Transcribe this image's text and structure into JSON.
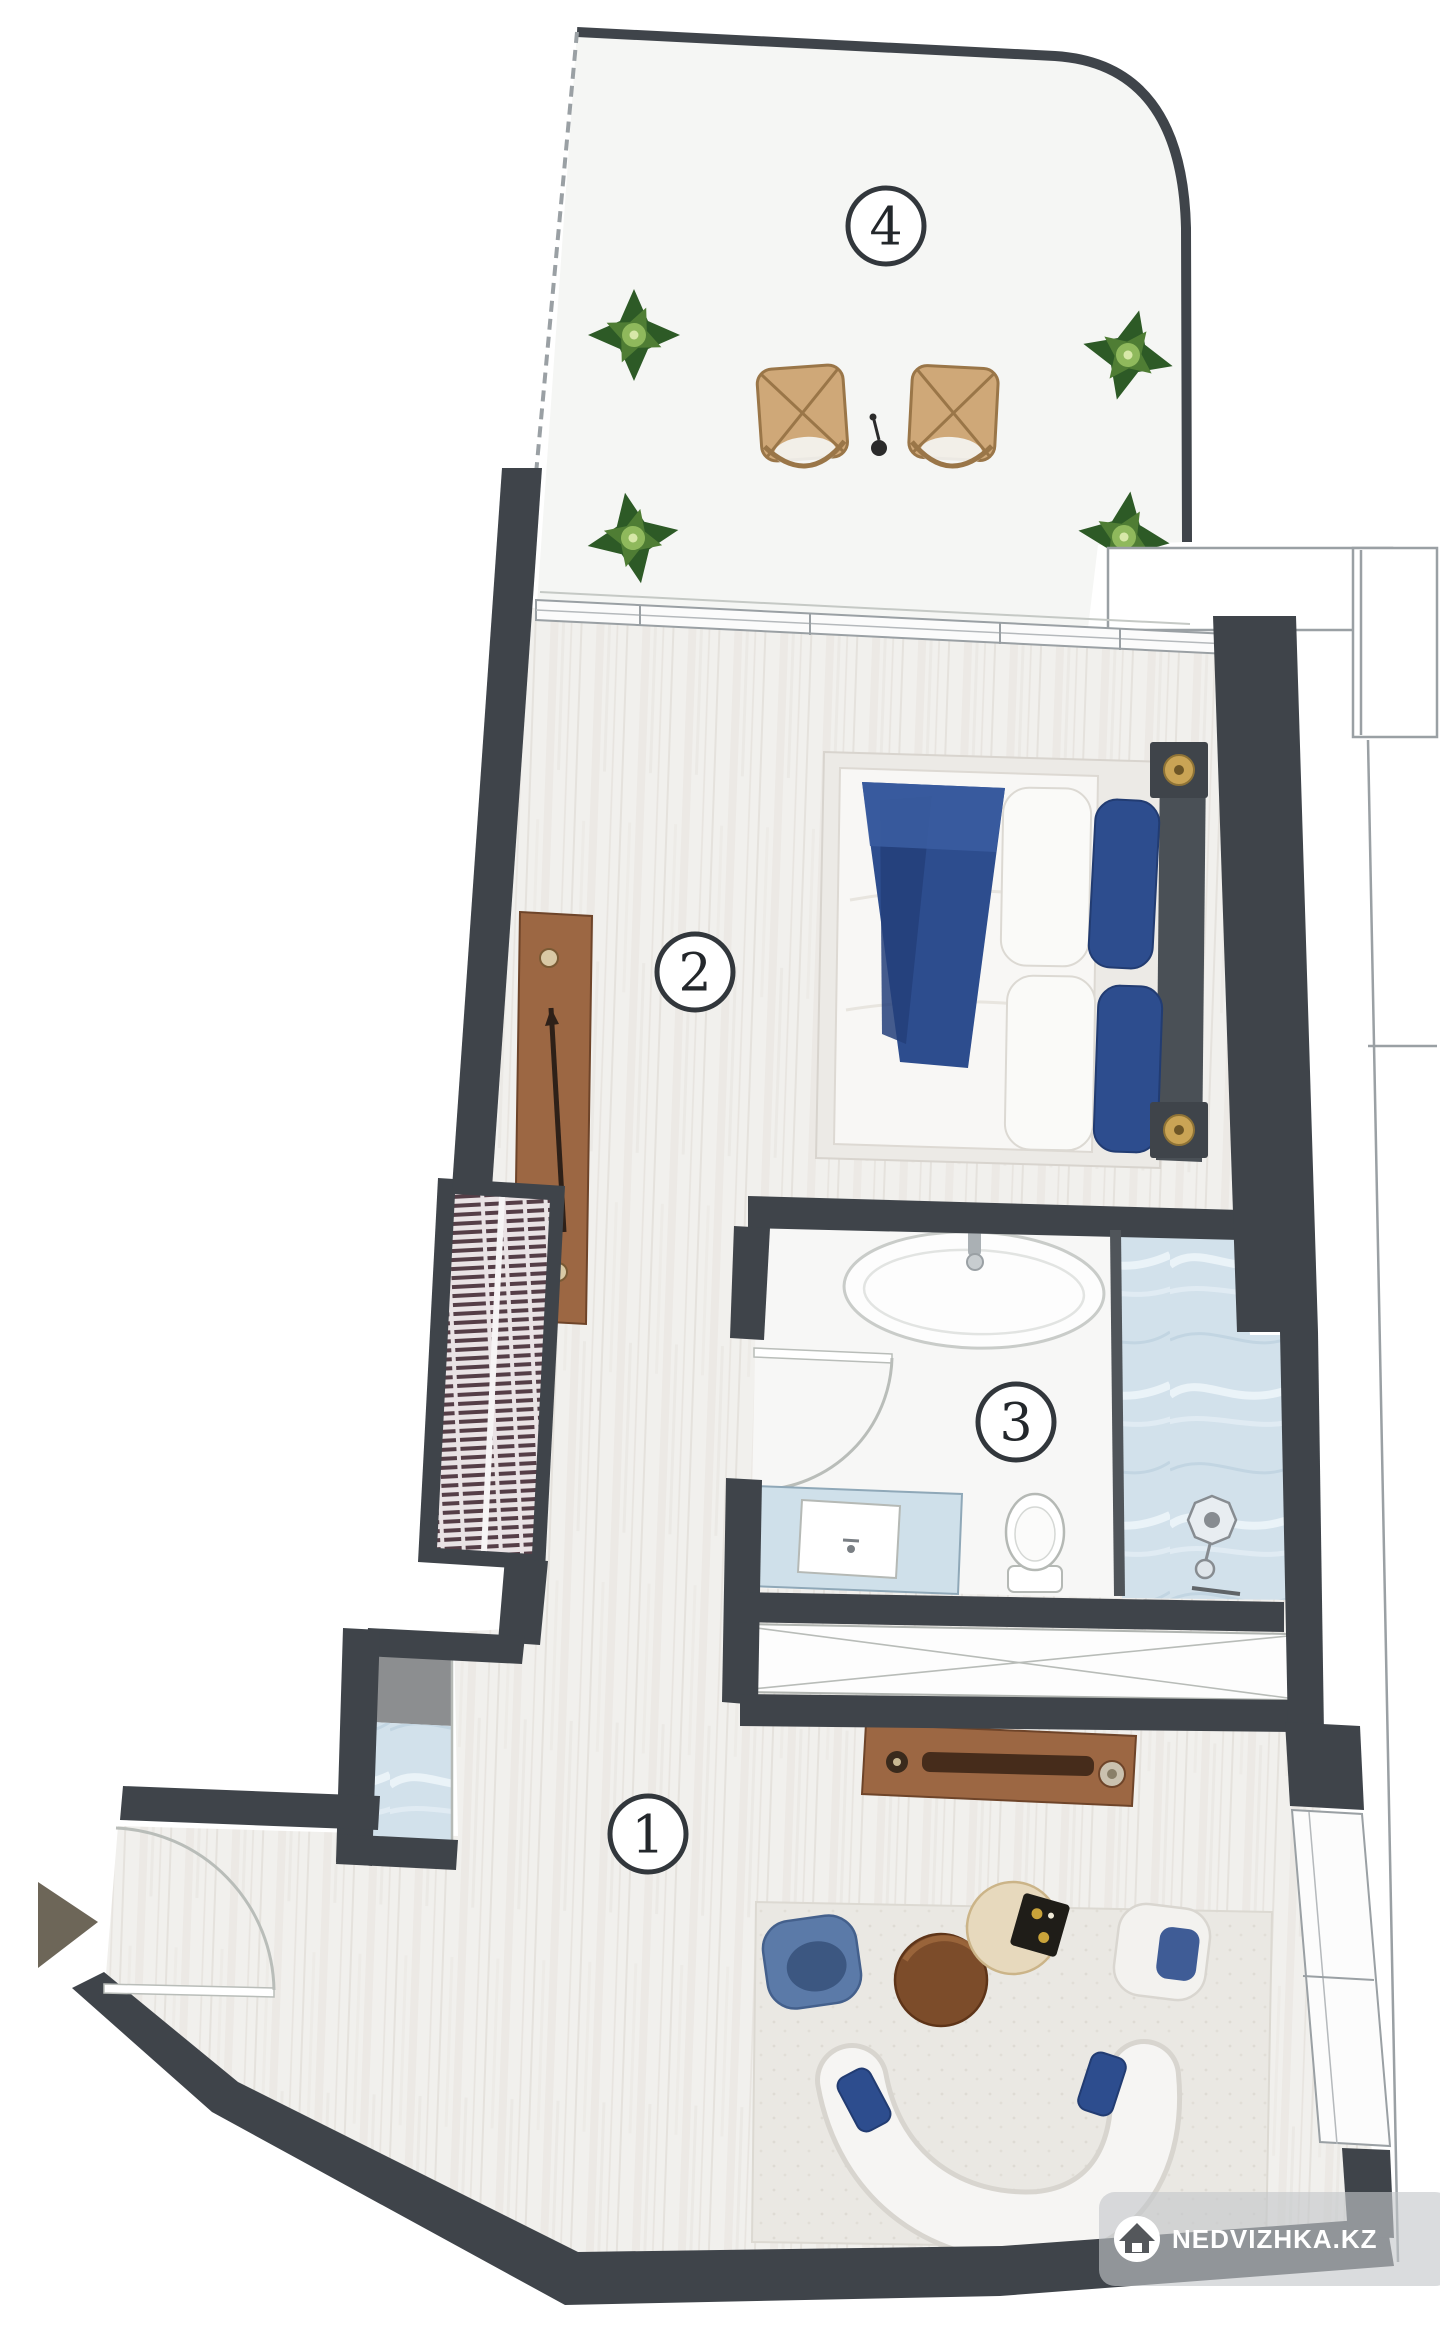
{
  "page": {
    "background": "#ffffff"
  },
  "plan": {
    "rooms": [
      {
        "number": "1",
        "area": "living-area"
      },
      {
        "number": "2",
        "area": "bedroom"
      },
      {
        "number": "3",
        "area": "bathroom"
      },
      {
        "number": "4",
        "area": "terrace"
      }
    ],
    "watermark": {
      "text": "NEDVIZHKA.KZ",
      "icon": "house-icon"
    },
    "colors": {
      "wall": "#3f444a",
      "wood_floor": "#f1f0ed",
      "terrace_floor": "#f5f6f4",
      "marble_blue": "#d2e1eb",
      "navy_textile": "#2d4d8e",
      "wood_furniture": "#9c6743",
      "plant_green": "#2d5a26",
      "wicker_tan": "#cfa878",
      "watermark_bg": "#c3c6c9"
    }
  }
}
